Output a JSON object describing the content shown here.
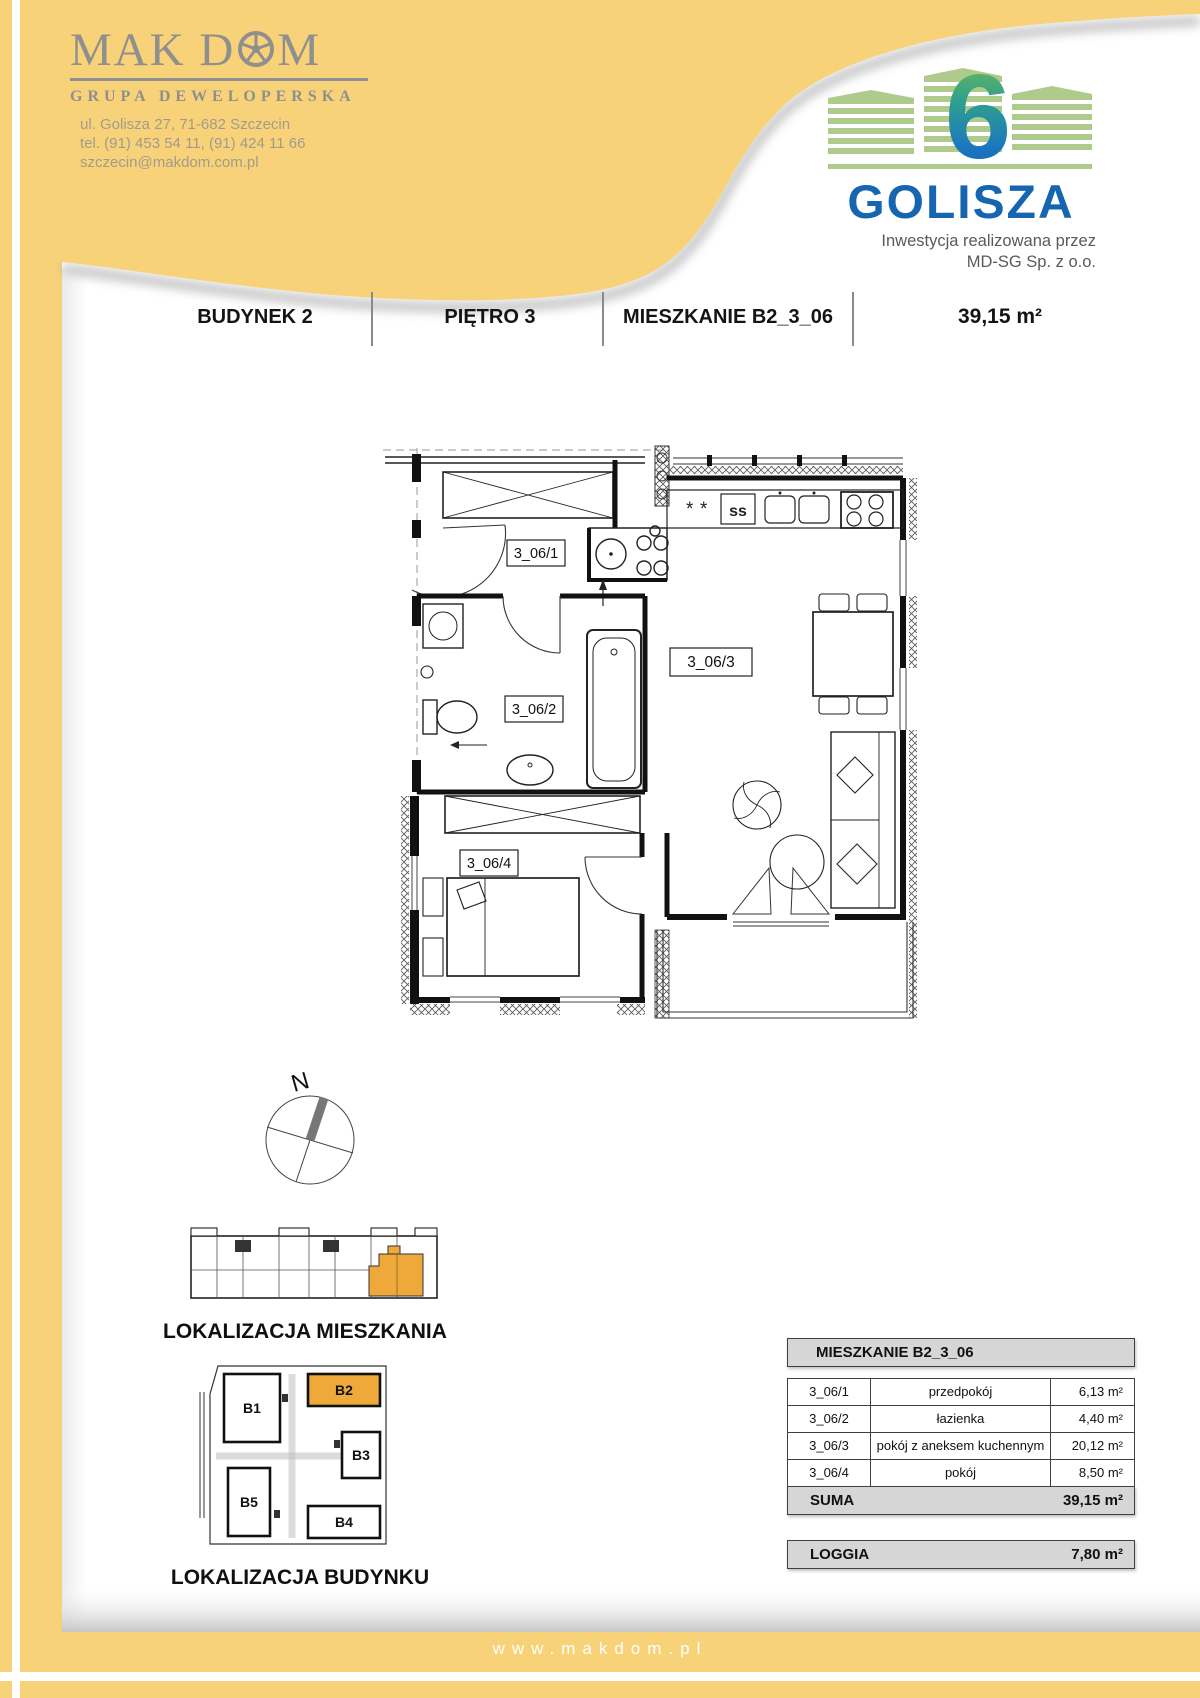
{
  "page": {
    "width": 1200,
    "height": 1698
  },
  "colors": {
    "yellow": "#F8D278",
    "orange": "#EFA93B",
    "logo_gray": "#8F8F8F",
    "golisza_blue": "#1565B0",
    "golisza_green": "#AECB8C",
    "table_gray": "#D6D6D6"
  },
  "branding": {
    "makdom": {
      "name_prefix": "MAK D",
      "name_suffix": "M",
      "tagline": "GRUPA DEWELOPERSKA",
      "address_line1": "ul. Golisza 27, 71-682 Szczecin",
      "address_line2": "tel. (91) 453 54 11, (91) 424 11 66",
      "address_line3": "szczecin@makdom.com.pl"
    },
    "golisza": {
      "number": "6",
      "name": "GOLISZA",
      "caption_line1": "Inwestycja realizowana przez",
      "caption_line2": "MD-SG Sp. z o.o."
    }
  },
  "header": {
    "building": "BUDYNEK 2",
    "floor": "PIĘTRO 3",
    "apartment": "MIESZKANIE B2_3_06",
    "area": "39,15 m²"
  },
  "plan": {
    "north_label": "N",
    "rooms": [
      {
        "label": "3_06/1"
      },
      {
        "label": "3_06/2"
      },
      {
        "label": "3_06/3"
      },
      {
        "label": "3_06/4"
      }
    ]
  },
  "locations": {
    "apartment_caption": "LOKALIZACJA MIESZKANIA",
    "building_caption": "LOKALIZACJA BUDYNKU",
    "buildings": [
      "B1",
      "B2",
      "B3",
      "B4",
      "B5"
    ]
  },
  "table": {
    "title": "MIESZKANIE B2_3_06",
    "rows": [
      {
        "code": "3_06/1",
        "name": "przedpokój",
        "area": "6,13 m²"
      },
      {
        "code": "3_06/2",
        "name": "łazienka",
        "area": "4,40 m²"
      },
      {
        "code": "3_06/3",
        "name": "pokój z aneksem kuchennym",
        "area": "20,12 m²"
      },
      {
        "code": "3_06/4",
        "name": "pokój",
        "area": "8,50 m²"
      }
    ],
    "suma_label": "SUMA",
    "suma_value": "39,15 m²",
    "loggia_label": "LOGGIA",
    "loggia_value": "7,80 m²"
  },
  "footer": {
    "url": "www.makdom.pl"
  }
}
